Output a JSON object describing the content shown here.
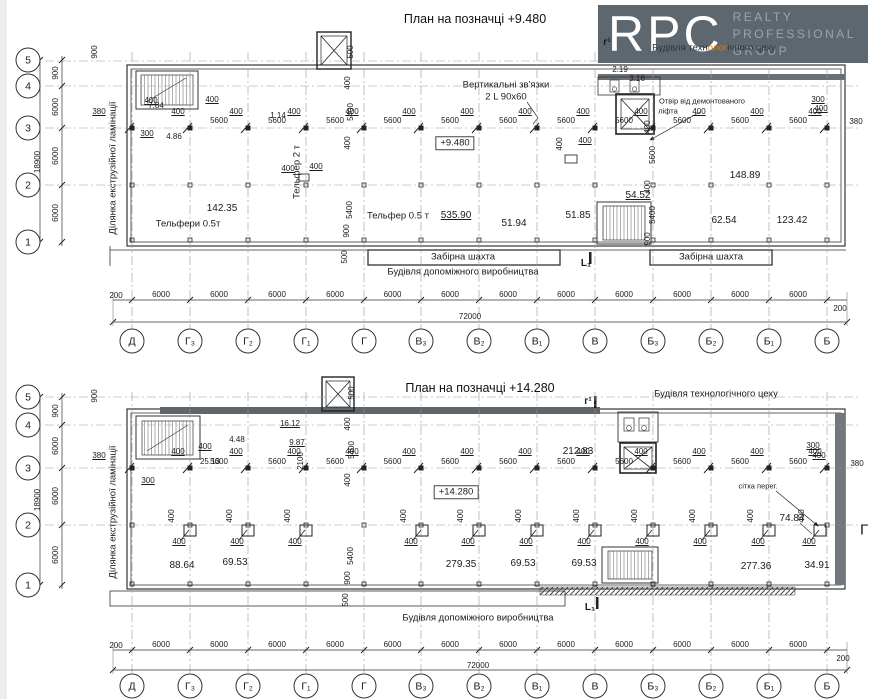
{
  "logo": {
    "abbr": "RPC",
    "words": [
      "REALTY",
      "PROFESSIONAL",
      "GROUP"
    ]
  },
  "overlay": {
    "pre": "Будівля техн",
    "hl": "олог",
    "post": "ічного цеху"
  },
  "grid": {
    "columns": [
      "Д",
      "Г₃",
      "Г₂",
      "Г₁",
      "Г",
      "В₃",
      "В₂",
      "В₁",
      "В",
      "Б₃",
      "Б₂",
      "Б₁",
      "Б"
    ],
    "col_x": [
      132,
      190,
      248,
      306,
      364,
      421,
      479,
      537,
      595,
      653,
      711,
      769,
      827
    ],
    "rows": [
      "5",
      "4",
      "3",
      "2",
      "1"
    ],
    "bay_pier": "400",
    "bay_span": "5600",
    "span": "6000",
    "edge": "200",
    "total": "72000"
  },
  "plan1": {
    "title": "План на позначці +9.480",
    "labels": [
      {
        "t": "г¹",
        "x": 607,
        "y": 43,
        "c": "mark"
      },
      {
        "t": "2.19",
        "x": 620,
        "y": 70,
        "c": "dim"
      },
      {
        "t": "3.16",
        "x": 637,
        "y": 79,
        "c": "dim"
      },
      {
        "t": "Вертикальні зв'язки",
        "x": 506,
        "y": 85,
        "c": "name"
      },
      {
        "t": "2 L 90x60",
        "x": 506,
        "y": 97,
        "c": "name"
      },
      {
        "t": "Отвір від демонтованого",
        "x": 702,
        "y": 101,
        "c": "small"
      },
      {
        "t": "ліфта",
        "x": 668,
        "y": 111,
        "c": "small"
      },
      {
        "t": "380",
        "x": 99,
        "y": 112,
        "c": "dim u"
      },
      {
        "t": "300",
        "x": 147,
        "y": 134,
        "c": "dim u"
      },
      {
        "t": "7.84",
        "x": 156,
        "y": 106,
        "c": "dim"
      },
      {
        "t": "400",
        "x": 151,
        "y": 101,
        "c": "dim u"
      },
      {
        "t": "400",
        "x": 212,
        "y": 100,
        "c": "dim u"
      },
      {
        "t": "1.14",
        "x": 278,
        "y": 116,
        "c": "dim"
      },
      {
        "t": "4.86",
        "x": 174,
        "y": 137,
        "c": "dim"
      },
      {
        "t": "300",
        "x": 818,
        "y": 100,
        "c": "dim u"
      },
      {
        "t": "400",
        "x": 821,
        "y": 109,
        "c": "dim u"
      },
      {
        "t": "380",
        "x": 856,
        "y": 122,
        "c": "dim"
      },
      {
        "t": "900",
        "x": 95,
        "y": 52,
        "c": "dim r"
      },
      {
        "t": "500",
        "x": 351,
        "y": 52,
        "c": "dim r"
      },
      {
        "t": "400",
        "x": 348,
        "y": 83,
        "c": "dim r"
      },
      {
        "t": "5400",
        "x": 351,
        "y": 112,
        "c": "dim r"
      },
      {
        "t": "400",
        "x": 348,
        "y": 143,
        "c": "dim r"
      },
      {
        "t": "5400",
        "x": 350,
        "y": 210,
        "c": "dim r"
      },
      {
        "t": "900",
        "x": 347,
        "y": 231,
        "c": "dim r"
      },
      {
        "t": "500",
        "x": 345,
        "y": 257,
        "c": "dim r"
      },
      {
        "t": "400",
        "x": 648,
        "y": 127,
        "c": "dim r"
      },
      {
        "t": "5600",
        "x": 653,
        "y": 155,
        "c": "dim r"
      },
      {
        "t": "400",
        "x": 648,
        "y": 187,
        "c": "dim r"
      },
      {
        "t": "5400",
        "x": 653,
        "y": 215,
        "c": "dim r"
      },
      {
        "t": "900",
        "x": 648,
        "y": 239,
        "c": "dim r"
      },
      {
        "t": "Тельфер 2 т",
        "x": 297,
        "y": 172,
        "c": "name r"
      },
      {
        "t": "400",
        "x": 288,
        "y": 169,
        "c": "dim u"
      },
      {
        "t": "400",
        "x": 316,
        "y": 167,
        "c": "dim u"
      },
      {
        "t": "400",
        "x": 560,
        "y": 144,
        "c": "dim r"
      },
      {
        "t": "400",
        "x": 585,
        "y": 141,
        "c": "dim u"
      },
      {
        "t": "142.35",
        "x": 222,
        "y": 209,
        "c": "val"
      },
      {
        "t": "Тельфери 0.5т",
        "x": 188,
        "y": 224,
        "c": "name"
      },
      {
        "t": "Тельфер 0.5 т",
        "x": 398,
        "y": 216,
        "c": "name"
      },
      {
        "t": "535.90",
        "x": 456,
        "y": 216,
        "c": "val u"
      },
      {
        "t": "51.94",
        "x": 514,
        "y": 224,
        "c": "val"
      },
      {
        "t": "51.85",
        "x": 578,
        "y": 216,
        "c": "val"
      },
      {
        "t": "54.52",
        "x": 638,
        "y": 196,
        "c": "val u"
      },
      {
        "t": "148.89",
        "x": 745,
        "y": 176,
        "c": "val"
      },
      {
        "t": "62.54",
        "x": 724,
        "y": 221,
        "c": "val"
      },
      {
        "t": "123.42",
        "x": 792,
        "y": 221,
        "c": "val"
      },
      {
        "t": "Забірна шахта",
        "x": 463,
        "y": 257,
        "c": "name"
      },
      {
        "t": "Забірна шахта",
        "x": 711,
        "y": 257,
        "c": "name"
      },
      {
        "t": "Будівля допоміжного виробництва",
        "x": 463,
        "y": 272,
        "c": "name"
      },
      {
        "t": "L₁",
        "x": 586,
        "y": 264,
        "c": "mark"
      },
      {
        "t": "Ділянка екструзійної ламінації",
        "x": 113,
        "y": 168,
        "c": "name r"
      },
      {
        "t": "18900",
        "x": 38,
        "y": 162,
        "c": "dim r"
      },
      {
        "t": "900",
        "x": 56,
        "y": 73,
        "c": "dim r"
      },
      {
        "t": "6000",
        "x": 56,
        "y": 107,
        "c": "dim r"
      },
      {
        "t": "6000",
        "x": 56,
        "y": 156,
        "c": "dim r"
      },
      {
        "t": "6000",
        "x": 56,
        "y": 213,
        "c": "dim r"
      },
      {
        "t": "200",
        "x": 116,
        "y": 296,
        "c": "dim"
      },
      {
        "t": "200",
        "x": 840,
        "y": 309,
        "c": "dim"
      },
      {
        "t": "72000",
        "x": 470,
        "y": 317,
        "c": "dim"
      }
    ]
  },
  "plan2": {
    "title": "План на позначці +14.280",
    "elevation": "+14.280",
    "pier_dim": "400",
    "pier_xs": [
      190,
      248,
      306,
      422,
      479,
      537,
      595,
      653,
      711,
      769,
      820
    ],
    "labels": [
      {
        "t": "Будівля технологічного цеху",
        "x": 716,
        "y": 394,
        "c": "name"
      },
      {
        "t": "г¹",
        "x": 588,
        "y": 402,
        "c": "mark"
      },
      {
        "t": "16.12",
        "x": 290,
        "y": 424,
        "c": "dim u"
      },
      {
        "t": "4.48",
        "x": 237,
        "y": 440,
        "c": "dim"
      },
      {
        "t": "9.87",
        "x": 297,
        "y": 443,
        "c": "dim u"
      },
      {
        "t": "25.13",
        "x": 210,
        "y": 462,
        "c": "dim"
      },
      {
        "t": "400",
        "x": 205,
        "y": 447,
        "c": "dim u"
      },
      {
        "t": "212.83",
        "x": 578,
        "y": 452,
        "c": "val"
      },
      {
        "t": "2100",
        "x": 301,
        "y": 461,
        "c": "dim r"
      },
      {
        "t": "380",
        "x": 99,
        "y": 456,
        "c": "dim u"
      },
      {
        "t": "300",
        "x": 148,
        "y": 481,
        "c": "dim u"
      },
      {
        "t": "300",
        "x": 813,
        "y": 446,
        "c": "dim u"
      },
      {
        "t": "400",
        "x": 819,
        "y": 456,
        "c": "dim u"
      },
      {
        "t": "380",
        "x": 857,
        "y": 464,
        "c": "dim"
      },
      {
        "t": "500",
        "x": 352,
        "y": 393,
        "c": "dim r"
      },
      {
        "t": "400",
        "x": 348,
        "y": 424,
        "c": "dim r"
      },
      {
        "t": "5400",
        "x": 352,
        "y": 450,
        "c": "dim r"
      },
      {
        "t": "400",
        "x": 348,
        "y": 480,
        "c": "dim r"
      },
      {
        "t": "5400",
        "x": 351,
        "y": 556,
        "c": "dim r"
      },
      {
        "t": "900",
        "x": 348,
        "y": 578,
        "c": "dim r"
      },
      {
        "t": "500",
        "x": 346,
        "y": 600,
        "c": "dim r"
      },
      {
        "t": "+14.280",
        "x": 456,
        "y": 492,
        "c": "elev"
      },
      {
        "t": "сітка перег.",
        "x": 758,
        "y": 486,
        "c": "small"
      },
      {
        "t": "74.84",
        "x": 792,
        "y": 519,
        "c": "val"
      },
      {
        "t": "88.64",
        "x": 182,
        "y": 566,
        "c": "val"
      },
      {
        "t": "69.53",
        "x": 235,
        "y": 563,
        "c": "val"
      },
      {
        "t": "279.35",
        "x": 461,
        "y": 565,
        "c": "val"
      },
      {
        "t": "69.53",
        "x": 523,
        "y": 564,
        "c": "val"
      },
      {
        "t": "69.53",
        "x": 584,
        "y": 564,
        "c": "val"
      },
      {
        "t": "277.36",
        "x": 756,
        "y": 567,
        "c": "val"
      },
      {
        "t": "34.91",
        "x": 817,
        "y": 566,
        "c": "val"
      },
      {
        "t": "Будівля допоміжного виробництва",
        "x": 478,
        "y": 618,
        "c": "name"
      },
      {
        "t": "L₁",
        "x": 590,
        "y": 608,
        "c": "mark"
      },
      {
        "t": "Ділянка екструзійної ламінації",
        "x": 113,
        "y": 512,
        "c": "name r"
      },
      {
        "t": "Г",
        "x": 864,
        "y": 530,
        "c": "big"
      },
      {
        "t": "18900",
        "x": 38,
        "y": 500,
        "c": "dim r"
      },
      {
        "t": "900",
        "x": 56,
        "y": 411,
        "c": "dim r"
      },
      {
        "t": "6000",
        "x": 56,
        "y": 446,
        "c": "dim r"
      },
      {
        "t": "6000",
        "x": 56,
        "y": 496,
        "c": "dim r"
      },
      {
        "t": "6000",
        "x": 56,
        "y": 555,
        "c": "dim r"
      },
      {
        "t": "900",
        "x": 95,
        "y": 396,
        "c": "dim r"
      },
      {
        "t": "200",
        "x": 116,
        "y": 646,
        "c": "dim"
      },
      {
        "t": "200",
        "x": 843,
        "y": 659,
        "c": "dim"
      },
      {
        "t": "72000",
        "x": 478,
        "y": 666,
        "c": "dim"
      }
    ]
  },
  "plan1_elevation": "+9.480"
}
